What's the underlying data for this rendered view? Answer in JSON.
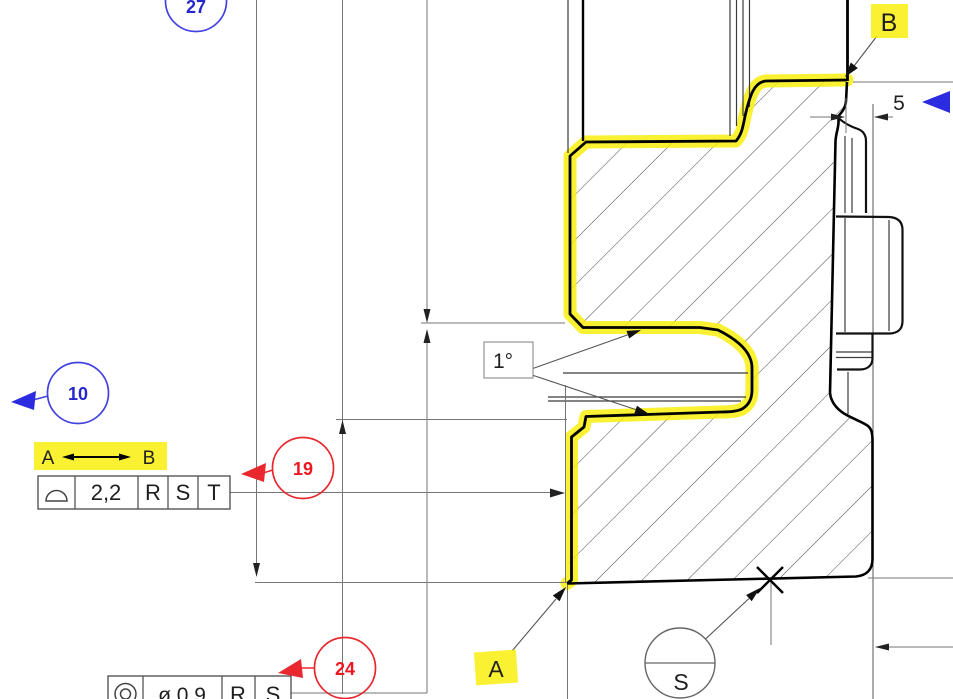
{
  "drawing": {
    "balloons": {
      "b27": "27",
      "b10": "10",
      "b19": "19",
      "b24": "24"
    },
    "dimensions": {
      "width_5": "5",
      "angle": "1°"
    },
    "fcf_surface_profile": {
      "symbol": "profile-of-a-surface",
      "value": "2,2",
      "datums": [
        "R",
        "S",
        "T"
      ]
    },
    "between": {
      "from": "A",
      "to": "B"
    },
    "fcf_concentricity": {
      "symbol": "concentricity",
      "value": "ø 0,9",
      "datums": [
        "R",
        "S"
      ]
    },
    "datum_flags": {
      "a": "A",
      "b": "B"
    },
    "datum_target": {
      "label": "S"
    },
    "colors": {
      "highlight": "#f8ee0d",
      "balloon_red": "#e8282e",
      "balloon_blue": "#4242e0",
      "outline": "#000000",
      "dim_line": "#767676"
    }
  }
}
